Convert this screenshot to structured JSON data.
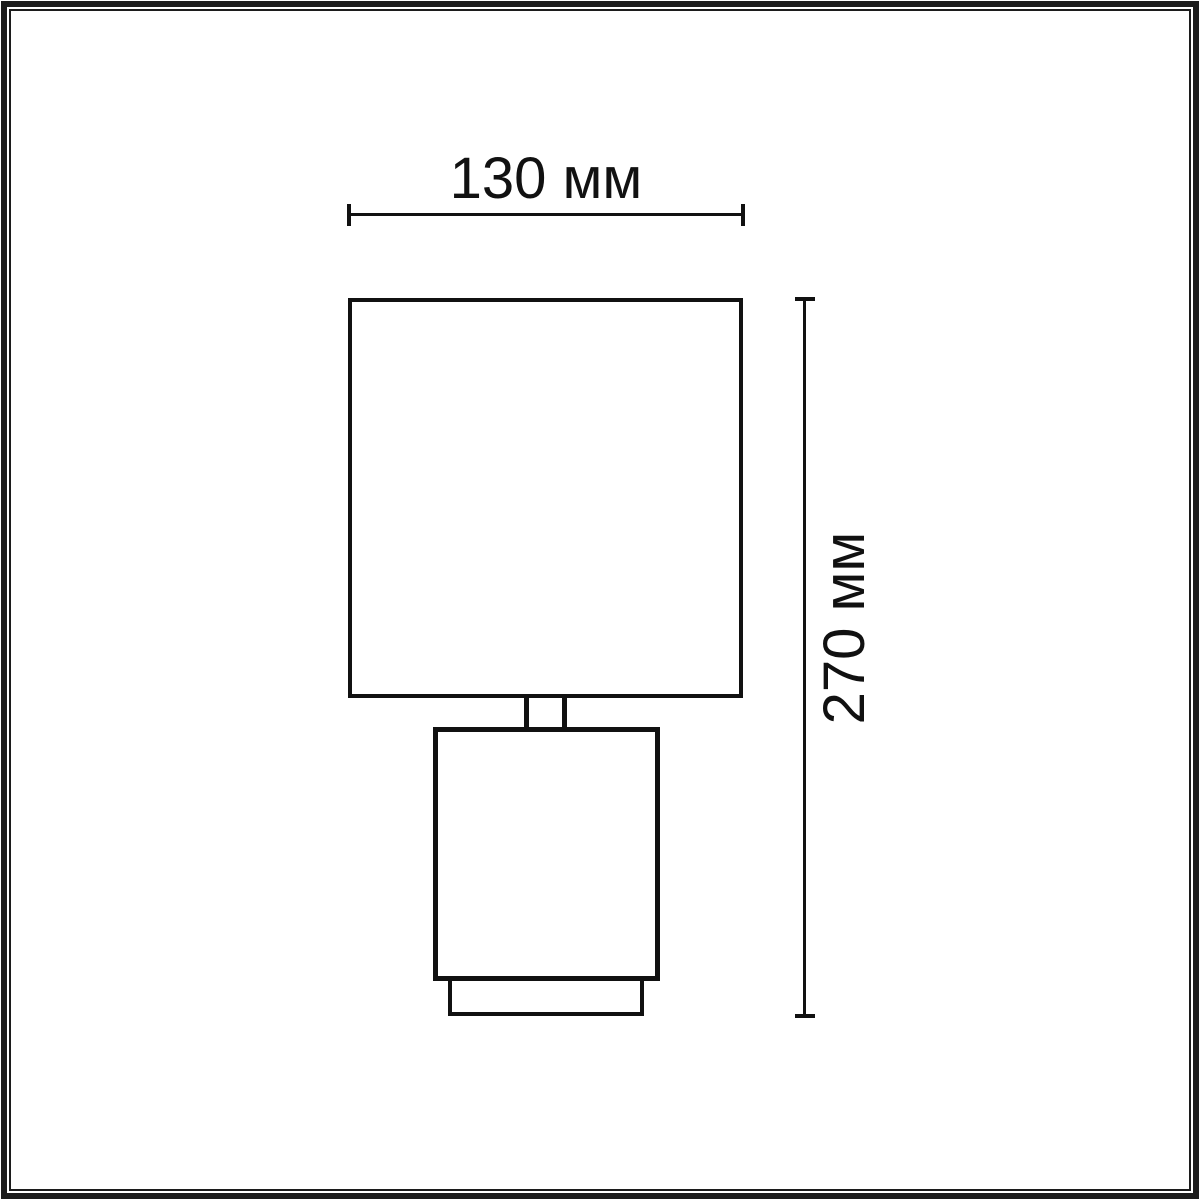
{
  "diagram": {
    "kind": "product-dimension-drawing",
    "subject": "table-lamp-front-elevation",
    "labels": {
      "width": "130 мм",
      "height": "270 мм"
    },
    "colors": {
      "background": "#ffffff",
      "line": "#111111",
      "frame": "#1c1c1c"
    },
    "parts": [
      "lamp-shade",
      "lamp-neck",
      "lamp-body",
      "lamp-base"
    ]
  }
}
